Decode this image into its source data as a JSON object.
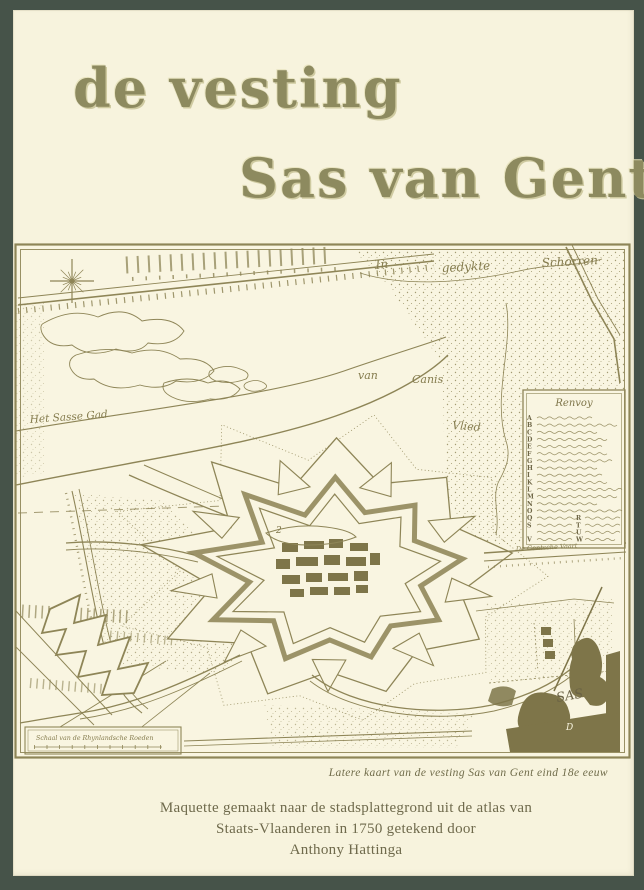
{
  "cover": {
    "title_line1": "de vesting",
    "title_line2": "Sas van Gent",
    "caption": "Latere kaart van de vesting Sas van Gent eind 18e eeuw",
    "credit_line1": "Maquette gemaakt naar de stadsplattegrond uit de atlas van",
    "credit_line2": "Staats-Vlaanderen in 1750 getekend door",
    "credit_line3": "Anthony Hattinga"
  },
  "map": {
    "labels": {
      "schorren_in": "In",
      "schorren_mid": "gedykte",
      "schorren_right": "Schorren",
      "van": "van",
      "canis": "Canis",
      "vlied": "Vlied",
      "sasse_gad": "Het Sasse Gad",
      "canal": "De Gentsche Vaart",
      "harbor_number": "2",
      "cartouche_sas": "SAS",
      "cartouche_d": "D",
      "scale_label": "Schaal van de Rhynlandsche Roeden"
    },
    "legend": {
      "title": "Renvoy",
      "rows": [
        [
          "A",
          ""
        ],
        [
          "B",
          ""
        ],
        [
          "C",
          ""
        ],
        [
          "D",
          ""
        ],
        [
          "E",
          ""
        ],
        [
          "F",
          ""
        ],
        [
          "G",
          ""
        ],
        [
          "H",
          ""
        ],
        [
          "I",
          ""
        ],
        [
          "K",
          ""
        ],
        [
          "L",
          ""
        ],
        [
          "M",
          ""
        ],
        [
          "N",
          ""
        ],
        [
          "O",
          ""
        ],
        [
          "Q",
          "R"
        ],
        [
          "S",
          "T"
        ],
        [
          "",
          "U"
        ],
        [
          "V",
          "W"
        ]
      ]
    }
  },
  "colors": {
    "cover_green": "#465349",
    "page_cream": "#f7f3dd",
    "map_ink": "#8e8557",
    "title_olive": "#8d8a5f",
    "text_olive": "#6f6a4c"
  }
}
